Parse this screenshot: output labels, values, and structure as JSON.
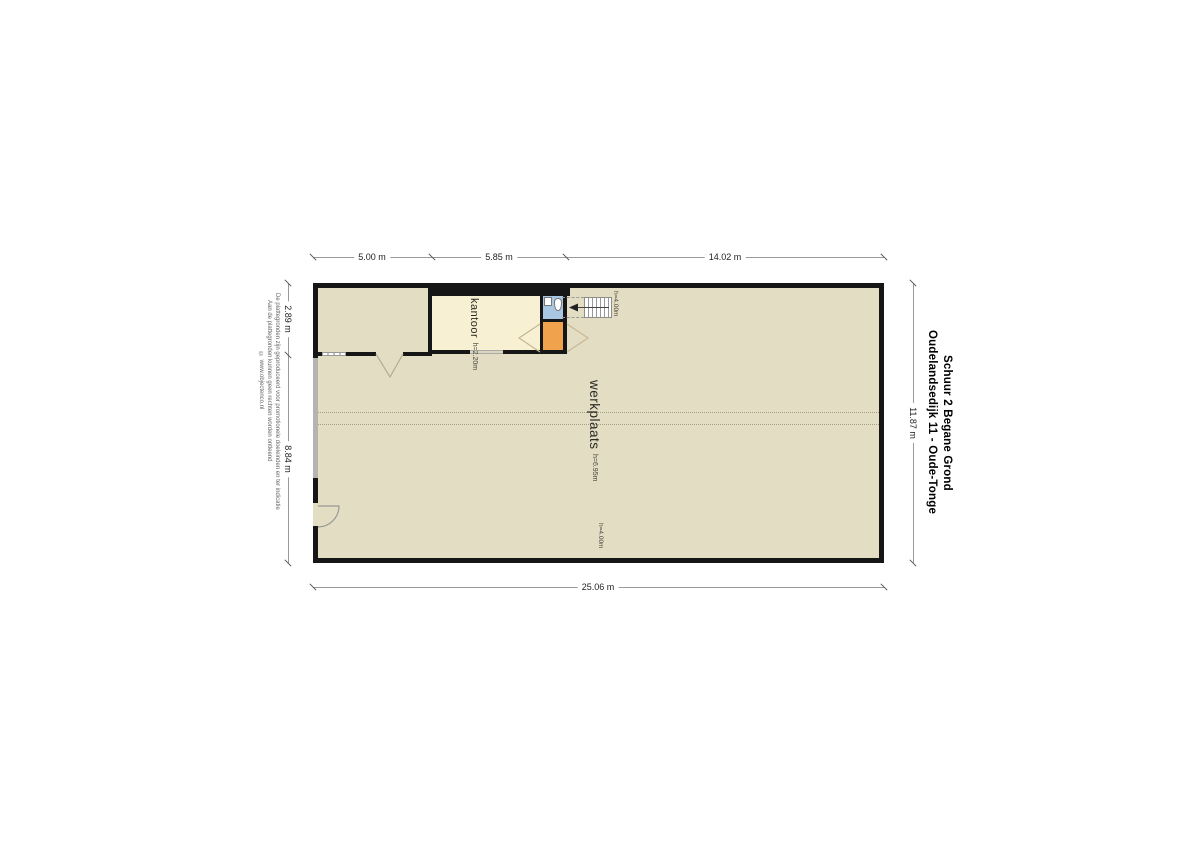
{
  "title": {
    "line1": "Oudelandsedijk 11 - Oude-Tonge",
    "line2": "Schuur 2 Begane Grond"
  },
  "disclaimer": {
    "line1": "De plattegronden zijn geproduceerd voor promotionele doeleinden en ter indicatie",
    "line2": "Aan de plattegronden kunnen geen rechten worden ontleend",
    "line3": "© www.objectenco.nl"
  },
  "dimensions": {
    "top": [
      {
        "label": "5.00 m"
      },
      {
        "label": "5.85 m"
      },
      {
        "label": "14.02 m"
      }
    ],
    "bottom": {
      "label": "25.06 m"
    },
    "left": [
      {
        "label": "2.89 m"
      },
      {
        "label": "8.84 m"
      }
    ],
    "right": {
      "label": "11.87 m"
    }
  },
  "rooms": {
    "kantoor": {
      "name": "kantoor",
      "height": "h=2.20m"
    },
    "werkplaats": {
      "name": "werkplaats",
      "height": "h=6.95m"
    }
  },
  "annotations": {
    "stairs_height": "h=4.00m",
    "rear_height": "h=4.00m"
  },
  "colors": {
    "floor": "#e3ddc4",
    "kantoor": "#f7f0d2",
    "toilet": "#a9c6e3",
    "landing": "#f0a34c",
    "wall": "#161616"
  }
}
